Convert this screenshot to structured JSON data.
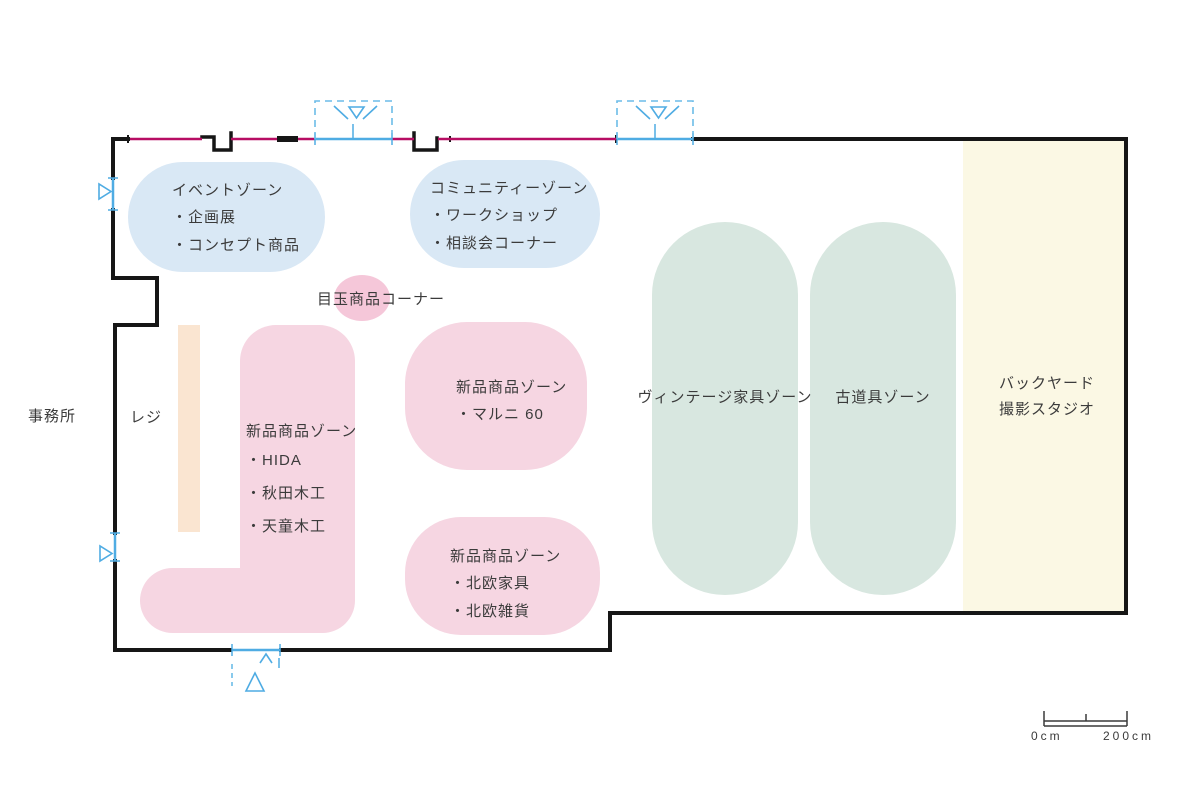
{
  "plan": {
    "office_label": "事務所",
    "register_label": "レジ",
    "spotlight_label": "目玉商品コーナー"
  },
  "zones": [
    {
      "id": "event",
      "title": "イベントゾーン",
      "items": [
        "・企画展",
        "・コンセプト商品"
      ]
    },
    {
      "id": "community",
      "title": "コミュニティーゾーン",
      "items": [
        "・ワークショップ",
        "・相談会コーナー"
      ]
    },
    {
      "id": "maruni",
      "title": "新品商品ゾーン",
      "items": [
        "・マルニ 60"
      ]
    },
    {
      "id": "domestic",
      "title": "新品商品ゾーン",
      "items": [
        "・HIDA",
        "・秋田木工",
        "・天童木工"
      ]
    },
    {
      "id": "nordic",
      "title": "新品商品ゾーン",
      "items": [
        "・北欧家具",
        "・北欧雑貨"
      ]
    },
    {
      "id": "vintage",
      "title": "ヴィンテージ家具ゾーン",
      "items": []
    },
    {
      "id": "antique",
      "title": "古道具ゾーン",
      "items": []
    },
    {
      "id": "backyard",
      "title": "バックヤード",
      "subtitle": "撮影スタジオ",
      "items": []
    }
  ],
  "scale_bar": {
    "start": "0cm",
    "end": "200cm"
  },
  "colors": {
    "zone_blue": "#D9E8F5",
    "zone_pink": "#F6D6E2",
    "spotlight_pink": "#F5C7D9",
    "zone_green": "#D8E7E0",
    "backyard_cream": "#FBF8E4",
    "register_peach": "#FAE5D1",
    "wall_black": "#161616",
    "window_magenta": "#B70D63",
    "door_blue": "#4FACE3",
    "text": "#3b3b3b"
  }
}
